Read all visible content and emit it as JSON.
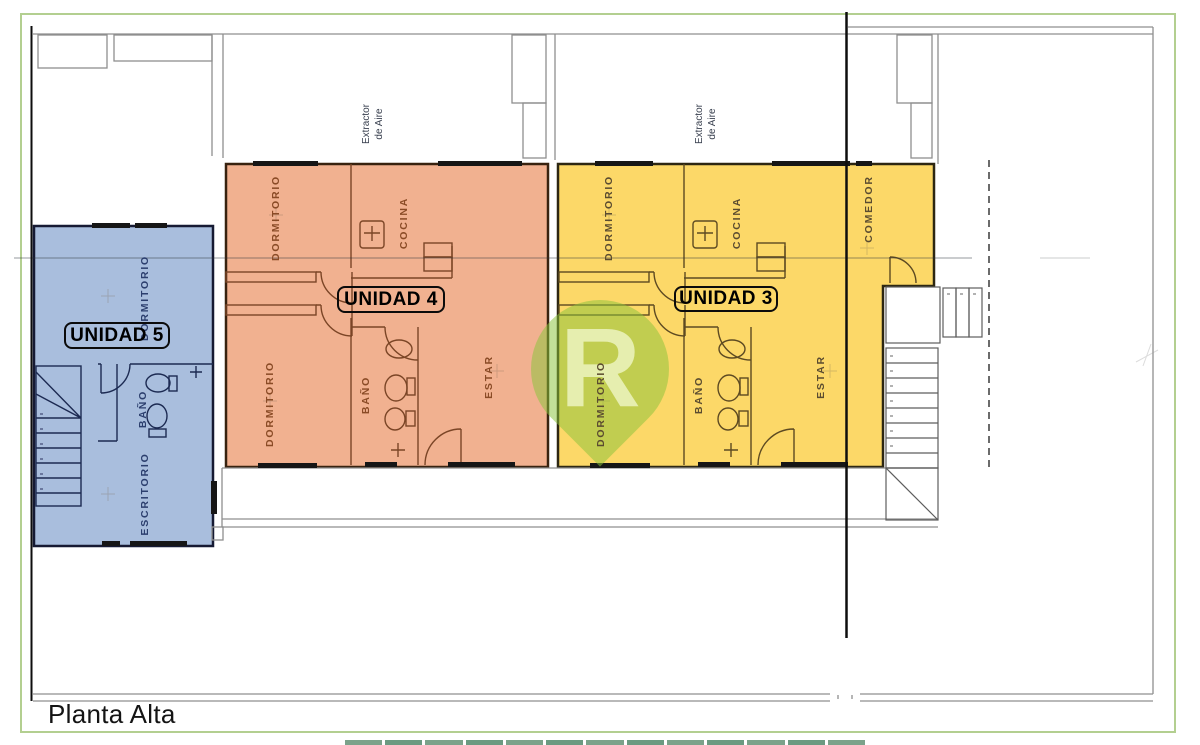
{
  "plan": {
    "title": "Planta Alta"
  },
  "watermark": {
    "letter": "R",
    "color": "#8cc63e"
  },
  "annotations": {
    "extractor": "Extractor\nde Aire"
  },
  "frame": {
    "color": "#b3cf90"
  },
  "units": {
    "unidad5": {
      "name": "UNIDAD 5",
      "fill": "#a9bedd",
      "rooms": {
        "dormitorio": "DORMITORIO",
        "bano": "BAÑO",
        "escritorio": "ESCRITORIO"
      }
    },
    "unidad4": {
      "name": "UNIDAD 4",
      "fill": "#f1b190",
      "rooms": {
        "dormitorio_1": "DORMITORIO",
        "cocina": "COCINA",
        "dormitorio_2": "DORMITORIO",
        "bano": "BAÑO",
        "estar": "ESTAR"
      }
    },
    "unidad3": {
      "name": "UNIDAD 3",
      "fill": "#fcd868",
      "rooms": {
        "dormitorio_1": "DORMITORIO",
        "cocina": "COCINA",
        "dormitorio_2": "DORMITORIO",
        "bano": "BAÑO",
        "estar": "ESTAR",
        "comedor": "COMEDOR"
      }
    }
  }
}
